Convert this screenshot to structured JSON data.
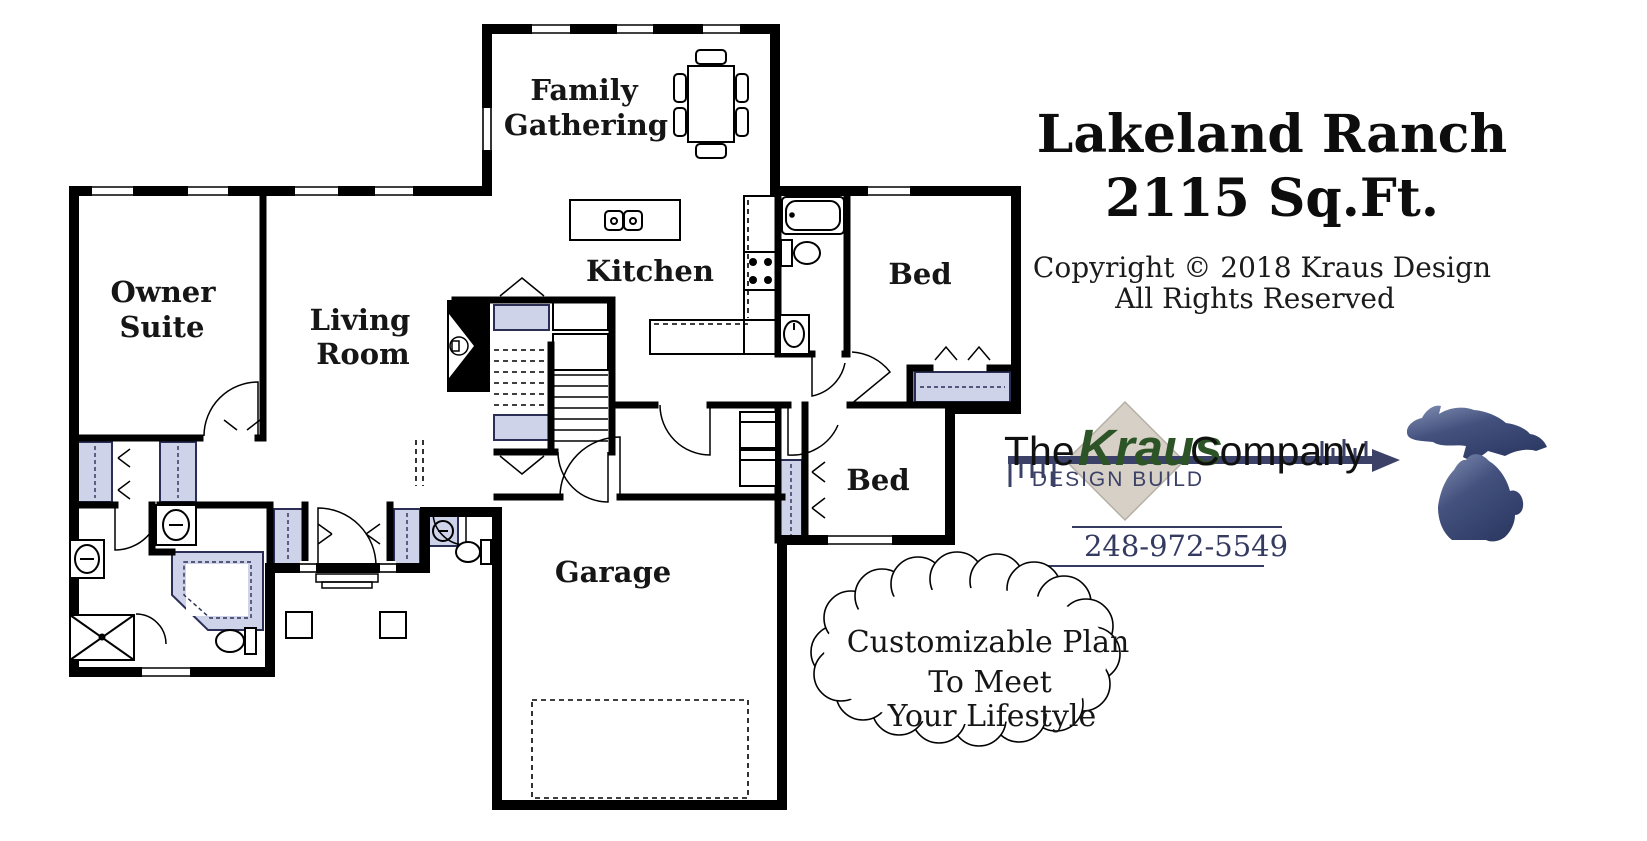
{
  "title": {
    "line1": "Lakeland Ranch",
    "line2": "2115 Sq.Ft.",
    "copyright1": "Copyright © 2018 Kraus Design",
    "copyright2": "All Rights Reserved"
  },
  "rooms": {
    "family1": "Family",
    "family2": "Gathering",
    "kitchen": "Kitchen",
    "owner1": "Owner",
    "owner2": "Suite",
    "living1": "Living",
    "living2": "Room",
    "bed_upper": "Bed",
    "bed_lower": "Bed",
    "garage": "Garage"
  },
  "logo": {
    "the": "The",
    "kraus": "Kraus",
    "company": "Company",
    "tagline": "DESIGN BUILD",
    "phone": "248-972-5549"
  },
  "callout": {
    "line1": "Customizable Plan",
    "line2": "To Meet",
    "line3": "Your Lifestyle"
  },
  "colors": {
    "wall": "#000000",
    "closet_fill": "#cfd3ea",
    "kraus_green": "#2c5426",
    "navy": "#3c4168",
    "diamond_fill": "#d6d0c7",
    "michigan_dark": "#2c3a64",
    "michigan_light": "#8290b4"
  }
}
